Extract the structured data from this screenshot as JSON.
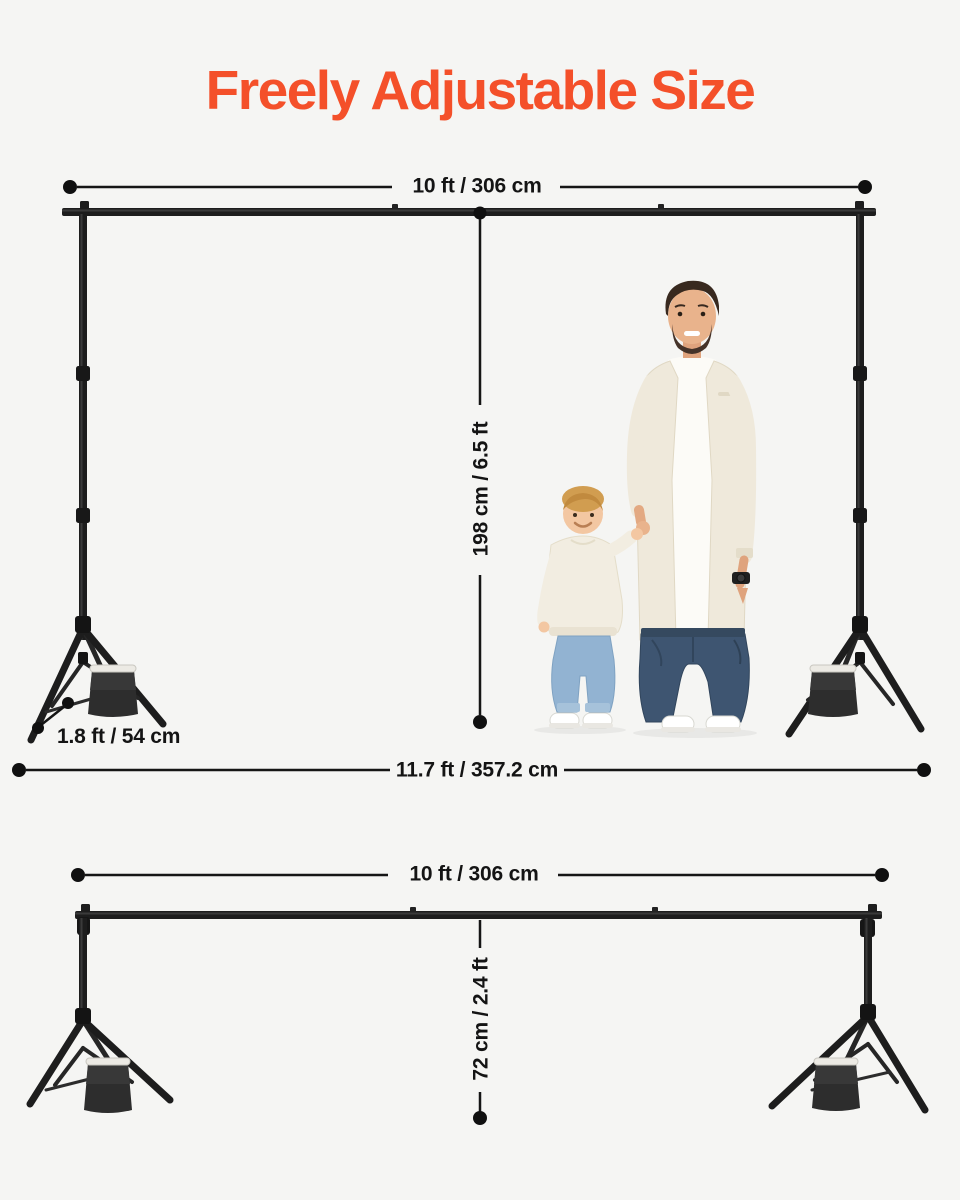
{
  "page": {
    "colors": {
      "bg": "#f5f5f3",
      "accent": "#f4502a",
      "ink": "#141414"
    }
  },
  "title": "Freely Adjustable Size",
  "diagram_full_height": {
    "width_label": "10 ft / 306 cm",
    "height_label": "198 cm / 6.5 ft",
    "leg_spread_label": "1.8 ft / 54 cm",
    "footprint_label": "11.7 ft / 357.2 cm"
  },
  "diagram_min_height": {
    "width_label": "10 ft / 306 cm",
    "height_label": "72 cm / 2.4 ft"
  }
}
